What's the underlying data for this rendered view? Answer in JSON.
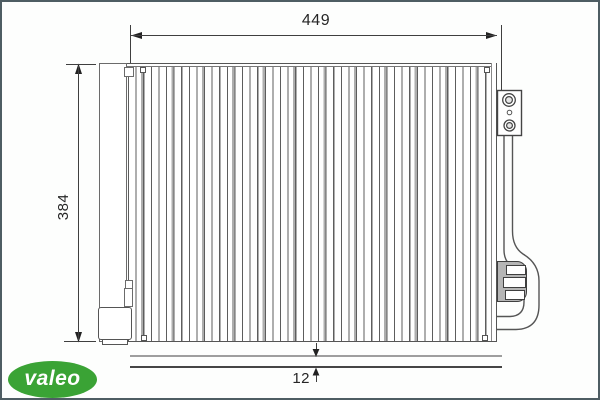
{
  "dims": {
    "width": "449",
    "height": "384",
    "thickness": "12"
  },
  "logo": {
    "text": "valeo",
    "color": "#3aa335"
  },
  "colors": {
    "frame": "#4e5d63",
    "line_dark": "#3f3f3f",
    "line_medium": "#6b6b6b",
    "line_gray": "#9e9e9e",
    "connector_fill": "#b5b5b5",
    "background": "#fdfefd"
  }
}
